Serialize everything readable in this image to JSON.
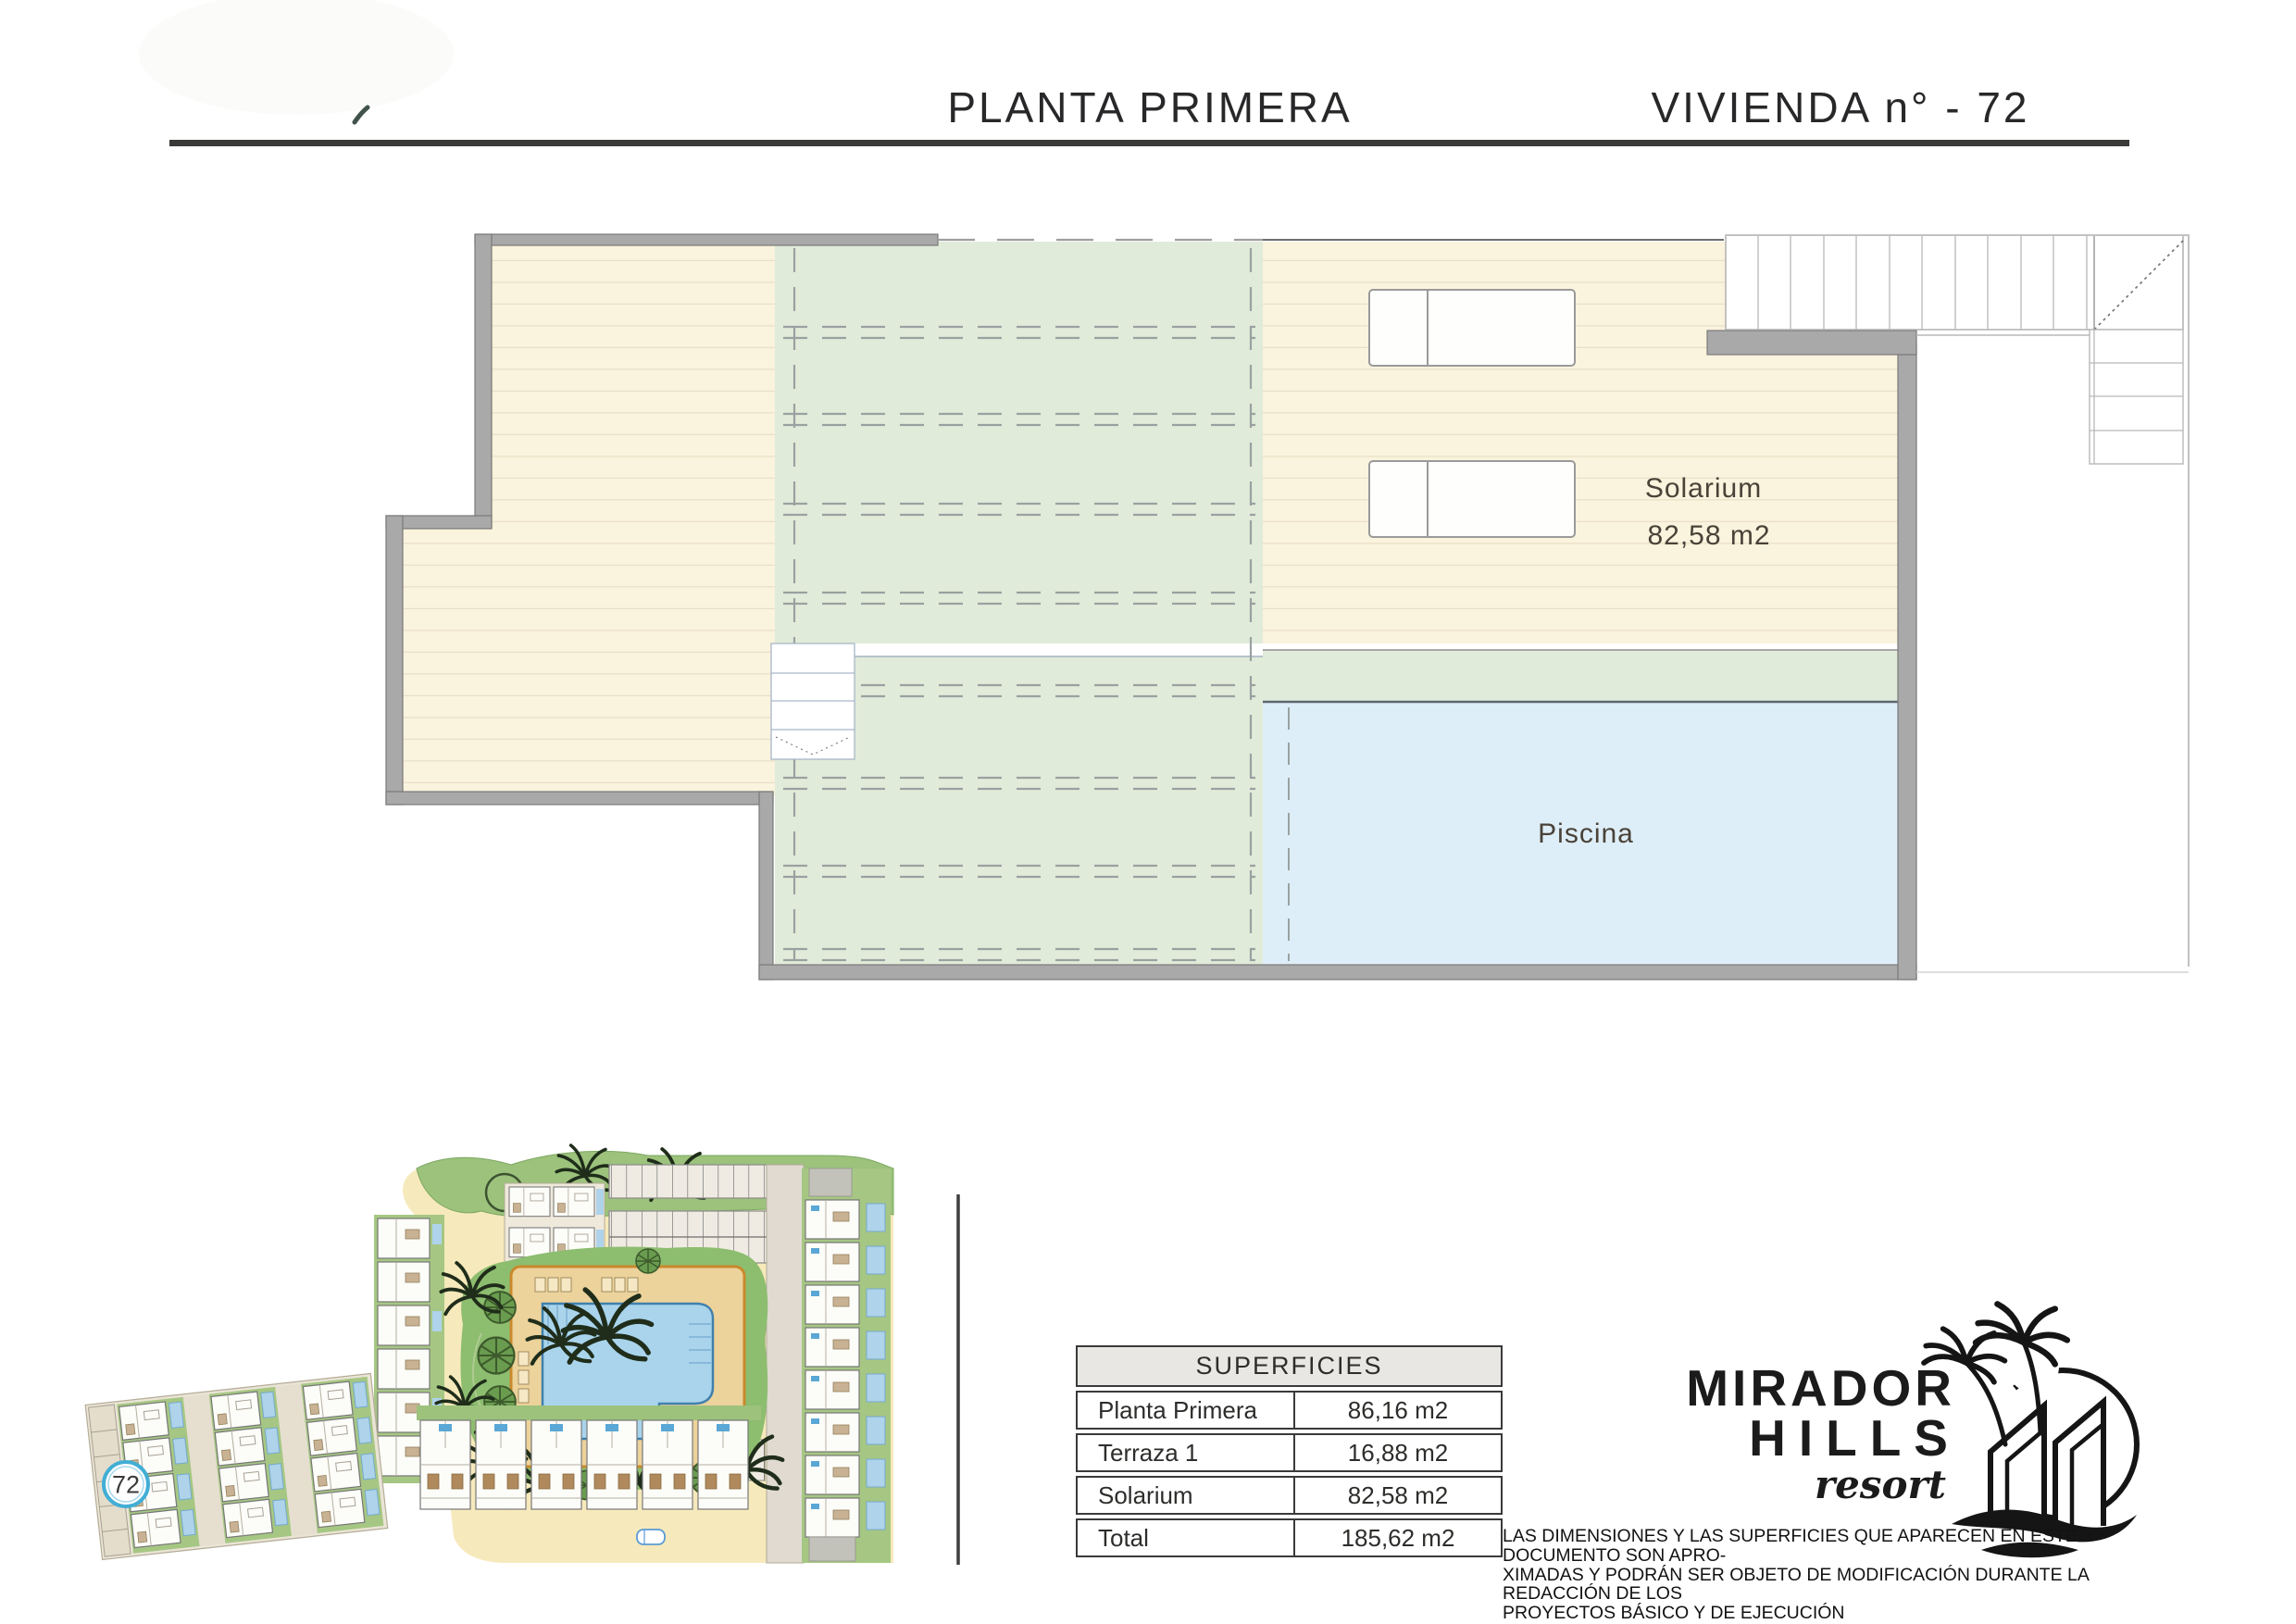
{
  "header": {
    "title_left": "PLANTA PRIMERA",
    "title_right": "VIVIENDA n° - 72"
  },
  "floor_plan": {
    "solarium_label": "Solarium",
    "solarium_area": "82,58 m2",
    "pool_label": "Piscina"
  },
  "site_plan": {
    "unit_badge": "72"
  },
  "table": {
    "title": "SUPERFICIES",
    "rows": [
      {
        "label": "Planta Primera",
        "value": "86,16 m2"
      },
      {
        "label": "Terraza 1",
        "value": "16,88 m2"
      },
      {
        "label": "Solarium",
        "value": "82,58 m2"
      },
      {
        "label": "Total",
        "value": "185,62 m2"
      }
    ]
  },
  "logo": {
    "name_line1": "MIRADOR",
    "name_line2": "HILLS",
    "name_line3": "resort"
  },
  "disclaimer": {
    "lines": [
      "LAS DIMENSIONES Y LAS SUPERFICIES QUE APARECEN EN ESTE DOCUMENTO SON APRO-",
      "XIMADAS Y PODRÁN SER OBJETO DE MODIFICACIÓN DURANTE LA REDACCIÓN DE LOS",
      "PROYECTOS BÁSICO Y DE EJECUCIÓN"
    ]
  },
  "colors": {
    "terrace_cream": "#faf3dd",
    "pergola_green": "#e1ebd9",
    "pool_blue": "#deeef8",
    "wall_gray": "#a9a9a9",
    "table_border": "#3a3a3a",
    "badge_blue": "#42aed6",
    "site_green": "#9cc27c",
    "site_sand": "#f6e9bb",
    "site_deck": "#ecd29b",
    "site_pool": "#a9d4ec"
  }
}
